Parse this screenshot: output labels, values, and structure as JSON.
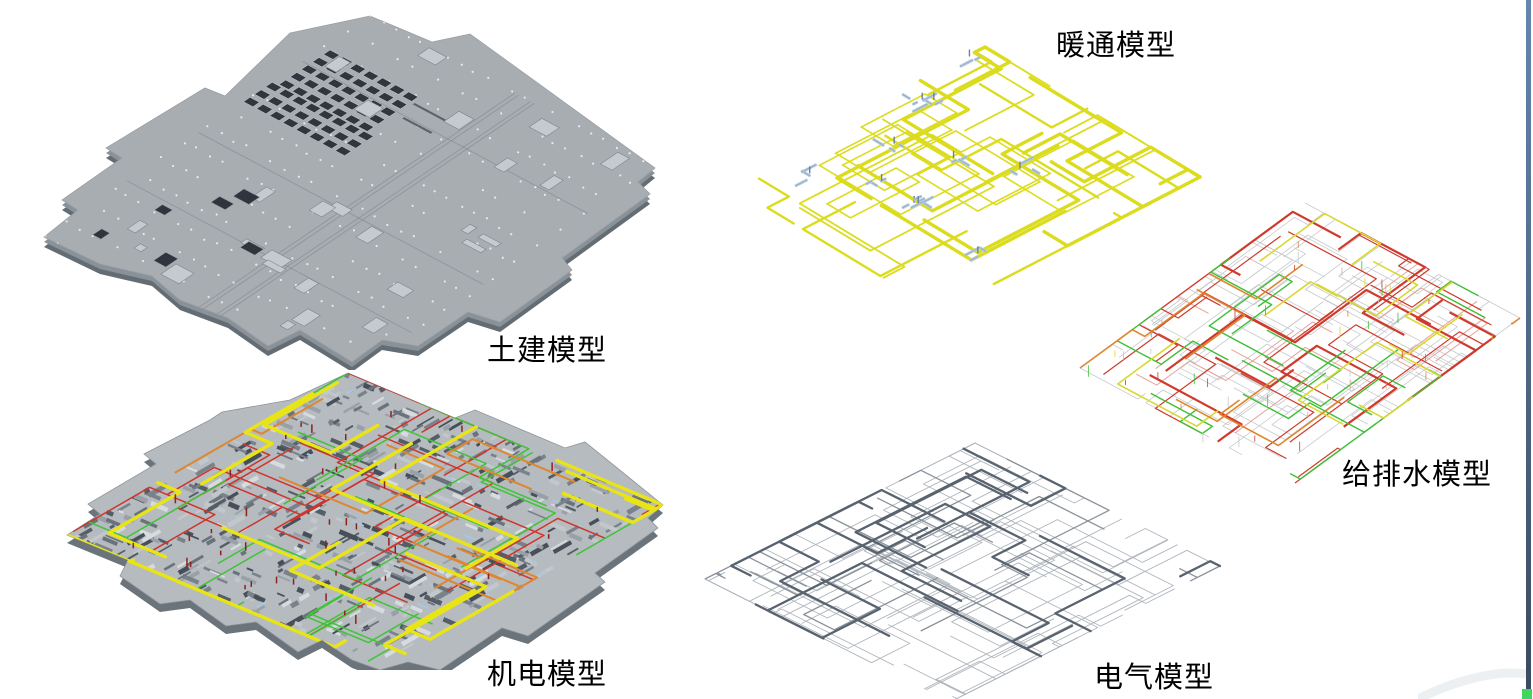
{
  "figure": {
    "labels": {
      "structural": "土建模型",
      "mep": "机电模型",
      "hvac": "暖通模型",
      "plumbing": "给排水模型",
      "electrical": "电气模型"
    }
  },
  "palette": {
    "background": "#ffffff",
    "label_text": "#000000",
    "slab_top": "#a8adb2",
    "slab_mid_edge": "#8a9299",
    "slab_dark_edge": "#646c74",
    "slab_box_light": "#c5cad0",
    "slab_box_line": "#7c848c",
    "slab_hole_dark": "#2e353c",
    "slab_slot_dark": "#2f363d",
    "slab_dot_white": "#eef1f3",
    "slab_joint": "#5a626a",
    "mep_base": "#b6bbc0",
    "mep_shadow": "#6b737b",
    "mep_grays": [
      "#555d66",
      "#79818a",
      "#99a0a7",
      "#d7dbdf",
      "#6a727b",
      "#c2c7cc",
      "#474f58"
    ],
    "mep_blue": "#a8c6de",
    "mep_tick_red": "#8c221c",
    "pipe_yellow": "#e8e416",
    "pipe_red": "#cf352a",
    "pipe_green": "#3fc436",
    "pipe_orange": "#de8630",
    "duct_yellow": "#dcdc1e",
    "equip_blue": "#b5cce0",
    "equip_blue_line": "#8fa9c2",
    "equip_slate": "#6e809a",
    "plumb_gray": "#c6c9cc",
    "plumb_red": "#cf3a2c",
    "plumb_pink": "#e4a39b",
    "plumb_green": "#3fbf37",
    "plumb_yellow": "#d8d832",
    "plumb_orange": "#de8630",
    "elec_light": "#b0b6bd",
    "elec_mid": "#8a919a",
    "elec_dark": "#59636f",
    "border_top": "#6286ad",
    "border_bottom": "#394a5f",
    "corner_green": "#43d65f",
    "arc_gray": "#e9edf0"
  },
  "render": {
    "structural": {
      "seed": 11,
      "boxes": 26,
      "holes": 7,
      "dots_u": 22,
      "dots_v": 14,
      "joints_u": 4,
      "joints_v": 3
    },
    "mep": {
      "seed": 23,
      "texture": 540,
      "blue": 28,
      "yellow": 14,
      "red": 15,
      "green": 12,
      "orange": 7,
      "ticks": 42
    },
    "hvac": {
      "seed": 37,
      "runs": 24,
      "loops": 8,
      "equip": 11
    },
    "plumbing": {
      "seed": 51,
      "gray": 44,
      "red": 22,
      "pink": 9,
      "green": 12,
      "yellow": 8,
      "orange": 6,
      "ticks": 48
    },
    "electrical": {
      "seed": 67,
      "light": 40,
      "mid": 11,
      "dark": 16
    }
  }
}
